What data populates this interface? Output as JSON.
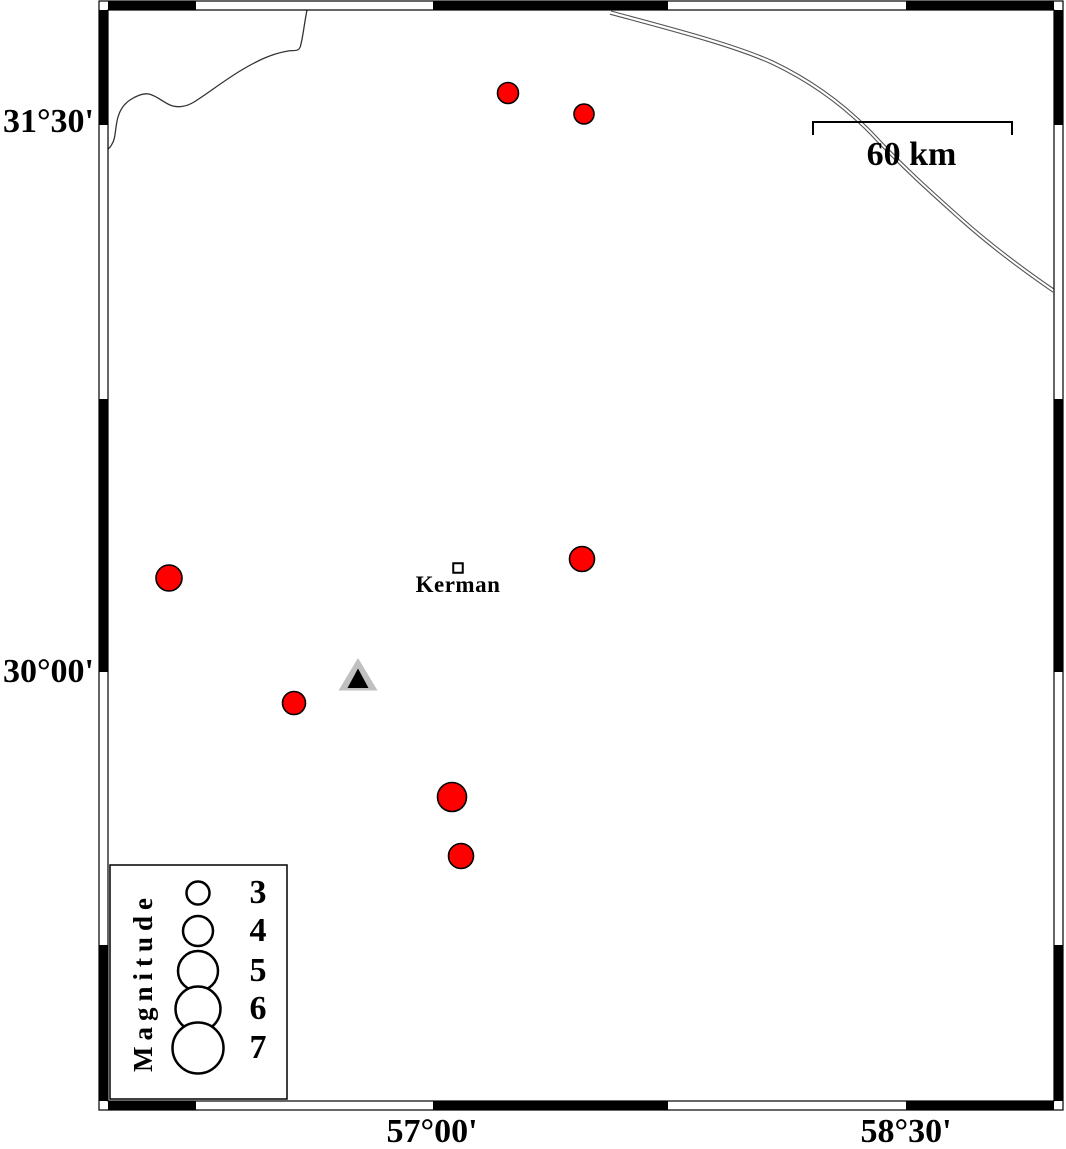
{
  "figure": {
    "description": "Seismicity map of the Kerman region with epicenters, a station triangle, scale bar and magnitude legend"
  },
  "axis_labels": {
    "lat": [
      {
        "label": "31°30'",
        "y": 122
      },
      {
        "label": "30°00'",
        "y": 672
      }
    ],
    "lon": [
      {
        "label": "57°00'",
        "x": 432
      },
      {
        "label": "58°30'",
        "x": 906
      }
    ]
  },
  "frame": {
    "outer": {
      "x": 99,
      "y": 1,
      "w": 964,
      "h": 1109
    },
    "inner": {
      "x": 108,
      "y": 10,
      "w": 946,
      "h": 1091
    },
    "band": 9,
    "top_bottom_black": [
      [
        108,
        196
      ],
      [
        433,
        668
      ],
      [
        906,
        1054
      ]
    ],
    "left_right_black": [
      [
        10,
        125
      ],
      [
        399,
        672
      ],
      [
        945,
        1101
      ]
    ]
  },
  "scale_bar": {
    "label": "60 km",
    "x1": 813,
    "x2": 1012,
    "y": 122,
    "tick": 13
  },
  "city": {
    "label": "Kerman",
    "x": 458,
    "y": 568,
    "size": 9.5
  },
  "station": {
    "outer_points": "358,658 338.5,690.5 377.5,690.5",
    "inner_points": "358,668.5 347.5,688 368.5,688",
    "outer_color": "#c0c0c0",
    "inner_color": "#000000"
  },
  "epicenters": {
    "color": "#ff0000",
    "points": [
      {
        "x": 508,
        "y": 93,
        "r": 10.5
      },
      {
        "x": 584,
        "y": 114,
        "r": 10
      },
      {
        "x": 169,
        "y": 578,
        "r": 13
      },
      {
        "x": 582,
        "y": 559,
        "r": 12.5
      },
      {
        "x": 294,
        "y": 703,
        "r": 11.5
      },
      {
        "x": 452,
        "y": 797,
        "r": 14.5
      },
      {
        "x": 461,
        "y": 856,
        "r": 12.5
      }
    ]
  },
  "legend": {
    "title": "Magnitude",
    "title_x": 143,
    "title_y": 982,
    "box": {
      "x": 110,
      "y": 865,
      "w": 177,
      "h": 234
    },
    "circle_x": 198,
    "label_x": 258,
    "items": [
      {
        "label": "3",
        "y": 893,
        "r": 11.5
      },
      {
        "label": "4",
        "y": 931,
        "r": 15
      },
      {
        "label": "5",
        "y": 971,
        "r": 20
      },
      {
        "label": "6",
        "y": 1009,
        "r": 22.5
      },
      {
        "label": "7",
        "y": 1048,
        "r": 25.5
      }
    ]
  },
  "map_lines": {
    "river_path": "M 307 10 C 304 25, 303 37, 300.5 46 C 299 52, 294 50, 288 51 C 270 54, 255 62, 240 71 C 222 82, 207 94, 194 102 C 186 107, 177 108, 170 105 C 163 102, 157 96, 149 94 C 143 93, 136 96, 130 100 C 124 104, 120 110, 118 117 C 115 127, 116 138, 112 144 C 110.5 147, 109.5 148, 108 149",
    "road_path": "M 611 11 C 670 27, 733 43, 773 61 C 813 80, 846 104, 876 136 C 906 168, 932 191, 961 217 C 990 243, 1022 267, 1054 289",
    "road_offset_x": -1,
    "road_offset_y": 3.2
  }
}
